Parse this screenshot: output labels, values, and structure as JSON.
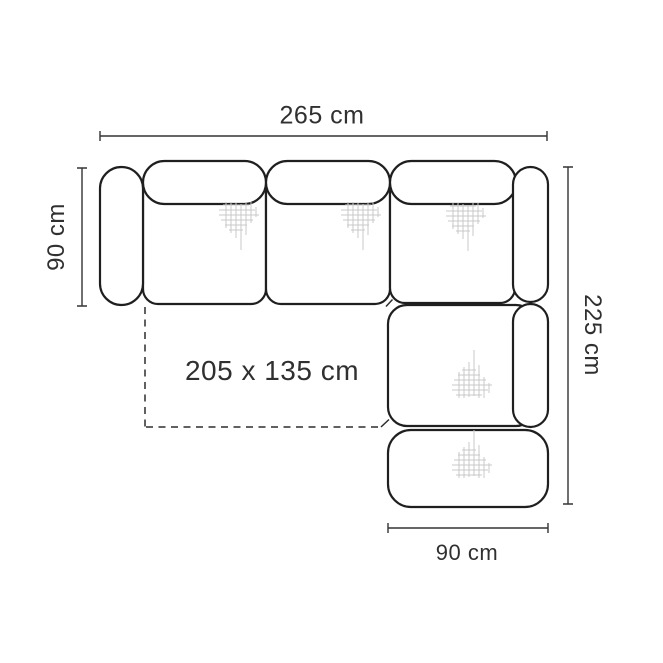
{
  "diagram": {
    "name": "Corner sofa top-view dimension drawing",
    "labels": {
      "overall_width": "265 cm",
      "seat_depth": "90 cm",
      "total_length": "225 cm",
      "chaise_width": "90 cm",
      "sleeping_area": "205 x 135 cm"
    },
    "colors": {
      "outline": "#1f1f1f",
      "dimension_lines": "#343434",
      "text": "#303030",
      "hatch": "#c8c8c8",
      "background": "#ffffff"
    }
  }
}
